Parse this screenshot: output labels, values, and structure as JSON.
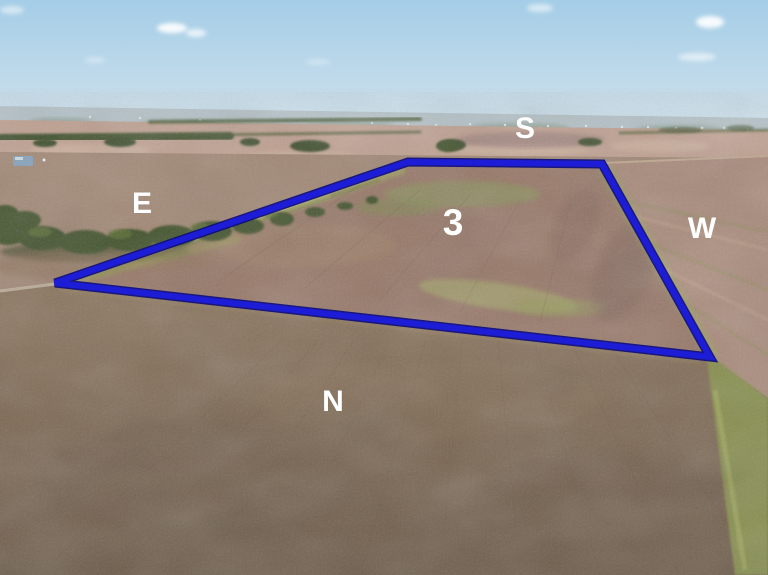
{
  "labels": {
    "tract_number": "3",
    "compass_south": "S",
    "compass_east": "E",
    "compass_west": "W",
    "compass_north": "N",
    "color": "#ffffff"
  },
  "boundary": {
    "points": "408,162 602,164 710,357 55,283",
    "stroke": "#1d1dd8",
    "outline": "#0b0b7e"
  },
  "palette": {
    "sky_top": "#a5cde7",
    "sky_horizon": "#d0e2ec",
    "haze": "#b4c2c8",
    "distant_fields": "#bfa090",
    "left_field": "#a08673",
    "tract_field": "#967767",
    "right_field": "#a88a7a",
    "corn_top": "#8a735c",
    "corn_bottom": "#6d5b49",
    "trees": "#41512c",
    "grass": "#87904e"
  }
}
